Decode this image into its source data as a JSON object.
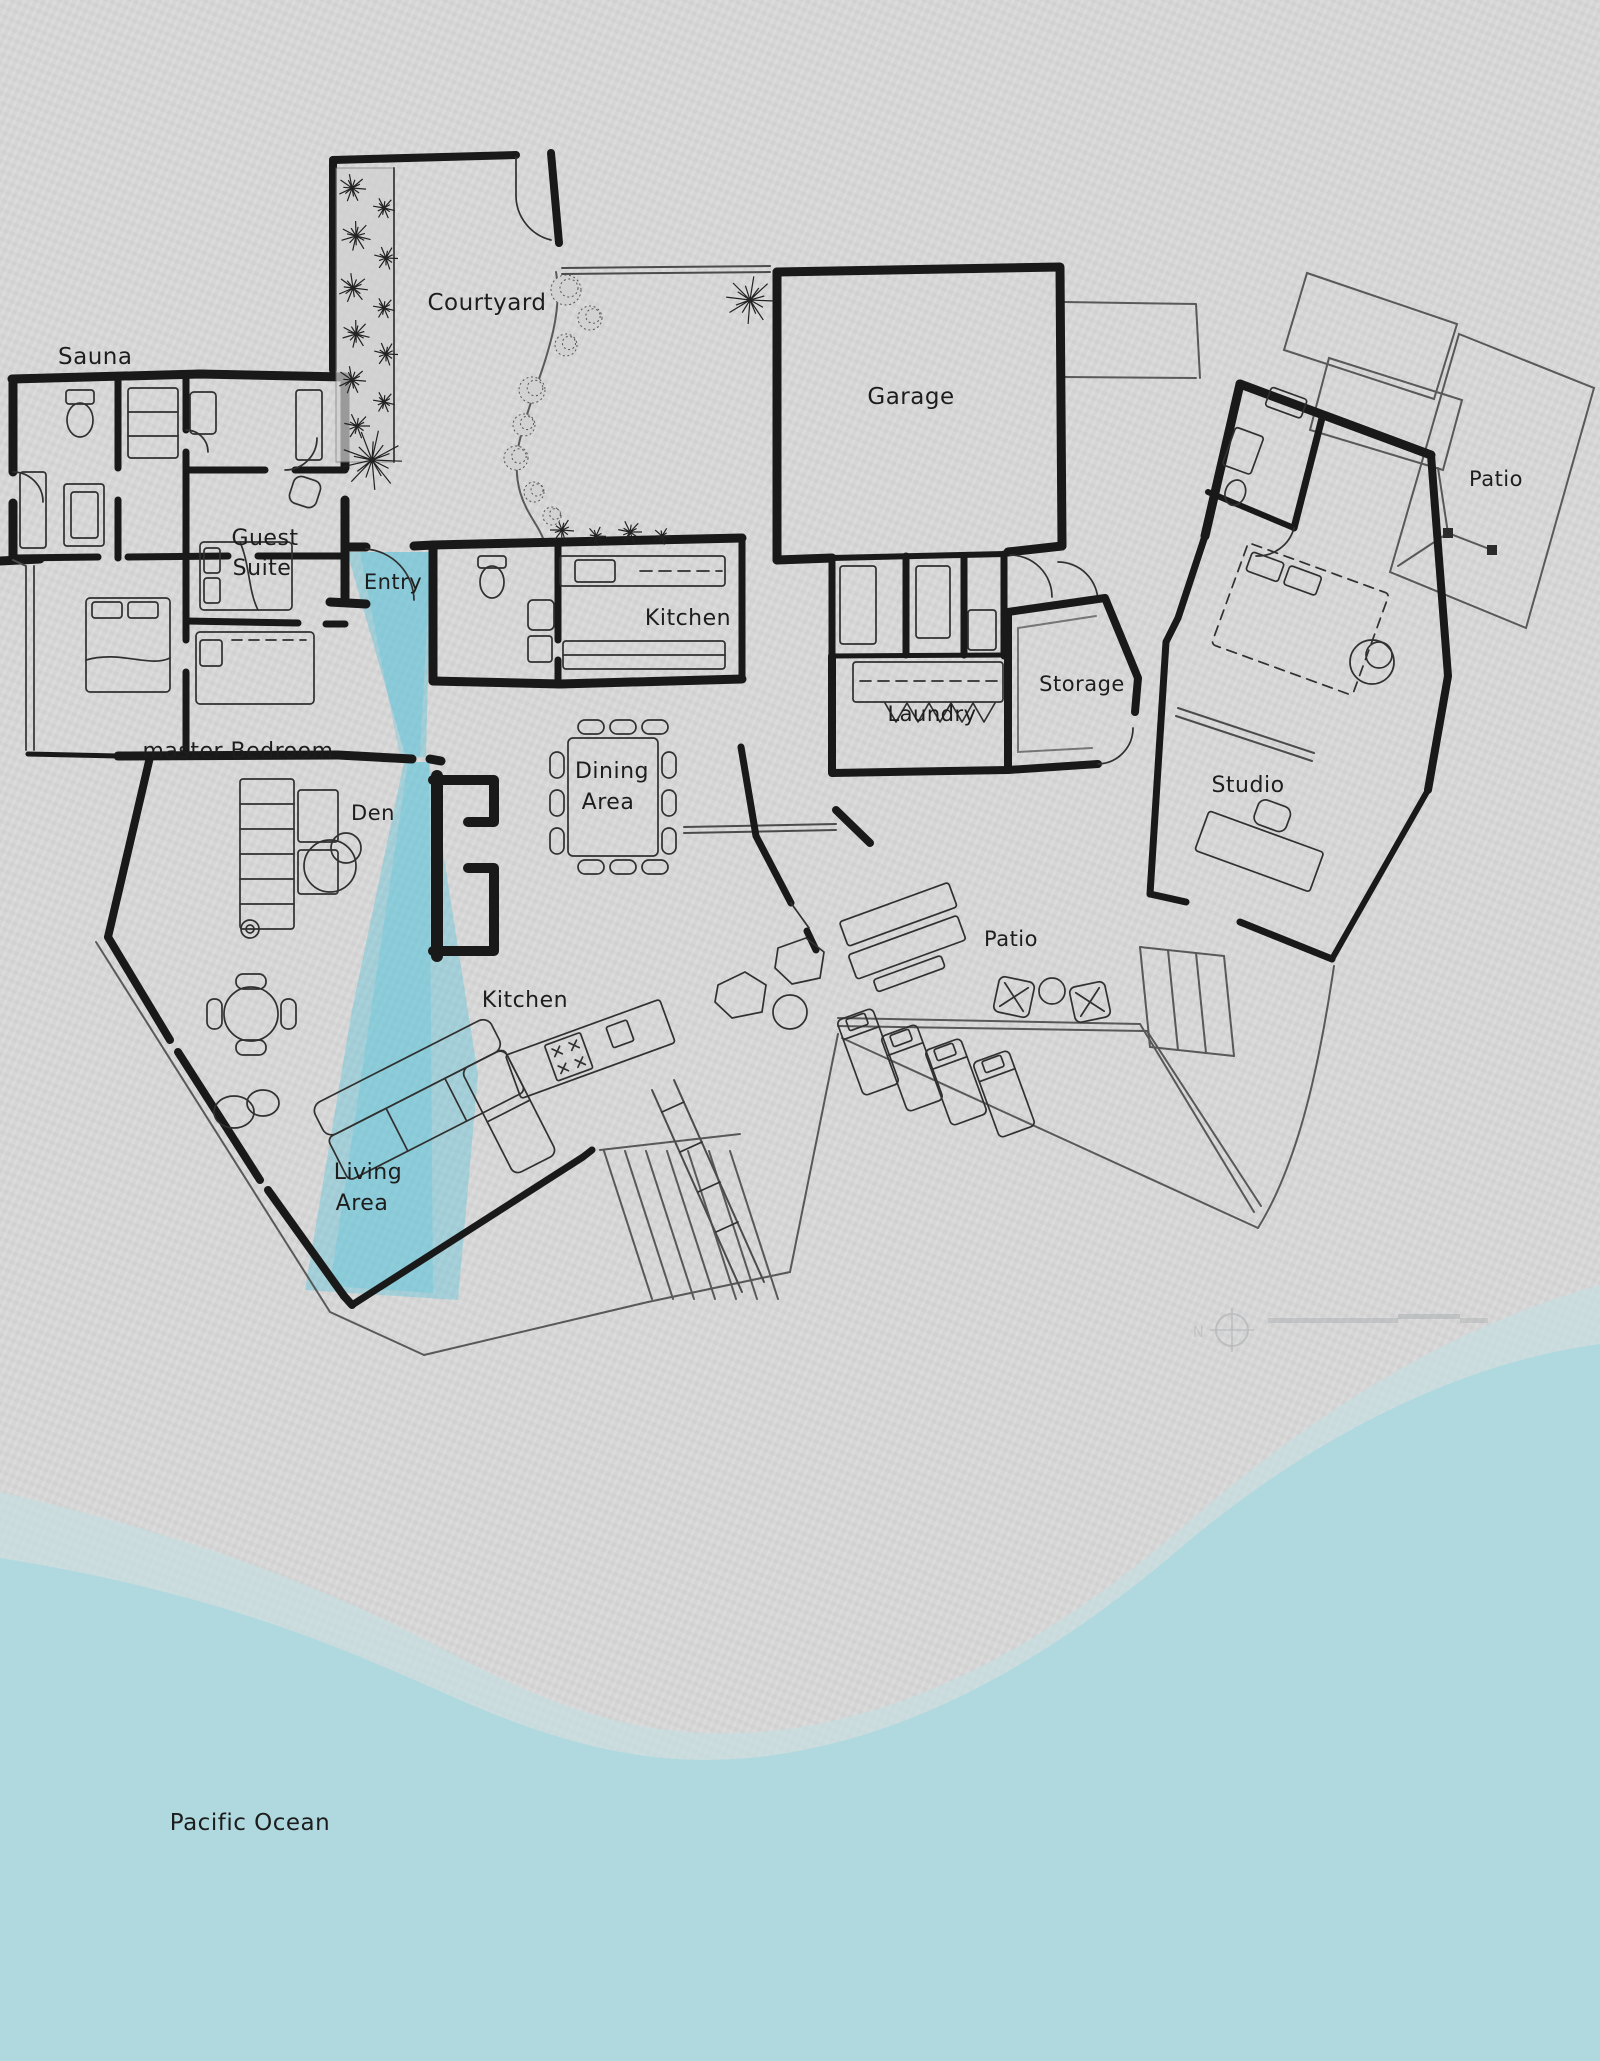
{
  "title": "Hand-drawn beach house floor plan",
  "colors": {
    "paper": "#d8d8d8",
    "ink": "#191919",
    "stream_water": "#57c2da",
    "ocean_water": "#afd9df",
    "shore_band": "#c3dfe2"
  },
  "labels": {
    "sauna": "Sauna",
    "courtyard": "Courtyard",
    "garage": "Garage",
    "patio_ne": "Patio",
    "guest_line1": "Guest",
    "guest_line2": "Suite",
    "entry": "Entry",
    "kitchen_upper": "Kitchen",
    "storage": "Storage",
    "laundry": "Laundry",
    "master_bedroom": "master Bedroom",
    "dining_line1": "Dining",
    "dining_line2": "Area",
    "den": "Den",
    "studio": "Studio",
    "kitchen_lower": "Kitchen",
    "patio_mid": "Patio",
    "living_line1": "Living",
    "living_line2": "Area",
    "ocean": "Pacific Ocean"
  },
  "compass": {
    "north_label": "N"
  }
}
